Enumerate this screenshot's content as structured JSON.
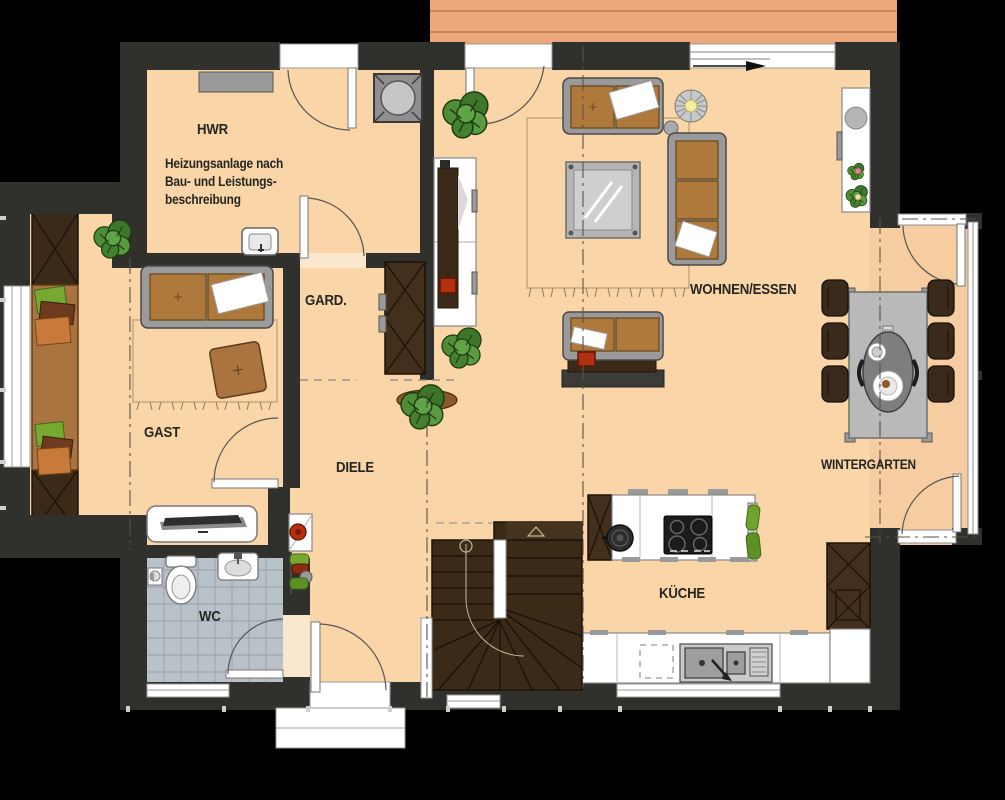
{
  "plan_title": "floor-plan",
  "rooms": {
    "hwr": {
      "label": "HWR"
    },
    "gard": {
      "label": "GARD."
    },
    "gast": {
      "label": "GAST"
    },
    "diele": {
      "label": "DIELE"
    },
    "wc": {
      "label": "WC"
    },
    "wohnen_essen": {
      "label": "WOHNEN/ESSEN"
    },
    "kueche": {
      "label": "KÜCHE"
    },
    "wintergarten": {
      "label": "WINTERGARTEN"
    }
  },
  "note": {
    "lines": [
      "Heizungsanlage nach",
      "Bau- und Leistungs-",
      "beschreibung"
    ]
  },
  "colors": {
    "wall": "#30302d",
    "floor": "#fad5a8",
    "floor_wintergarten": "#f6cda0",
    "terrace": "#eca77a",
    "tile": "#b9c1c9",
    "wood_dark": "#3b2a18",
    "wood_mid": "#a97440",
    "plant_green": "#4e8c35",
    "accent_red": "#b23010",
    "background": "#000000"
  }
}
